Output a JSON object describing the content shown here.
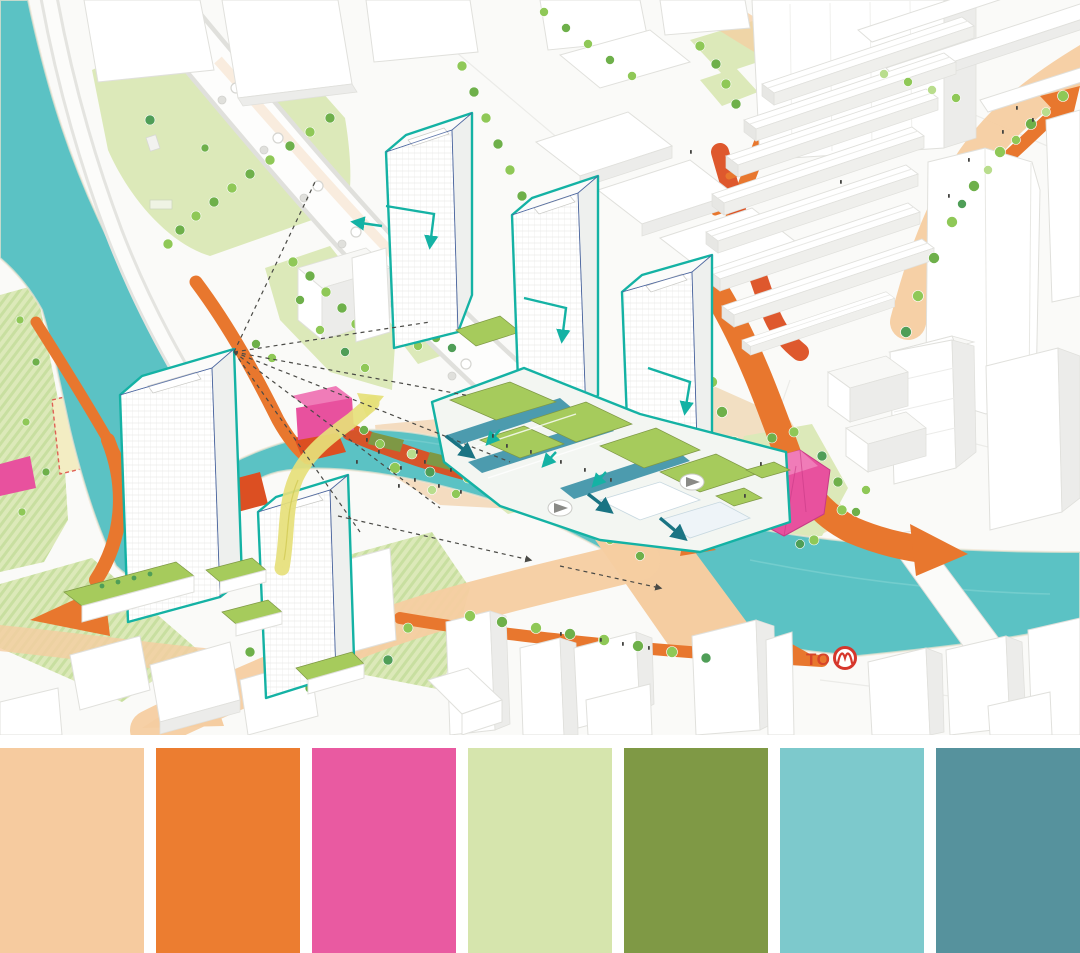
{
  "illustration": {
    "to_label": "TO",
    "icons": {
      "metro": "metro-roundel-icon",
      "viewpoint": "viewpoint-marker-icon",
      "flow": "orange-flow-arrow",
      "bridge": "yellow-bridge-arrow"
    },
    "theme": {
      "bg": "#fafaf8",
      "water": "#5bc2c4",
      "shore": "#efe4d2",
      "teal": "#14b2a4",
      "navy": "#46629c",
      "orange": "#e8772e",
      "orangeDeep": "#dc4f22",
      "peach": "#f5cda1",
      "yellow": "#e6e07a",
      "magenta": "#e8519e",
      "magentaLight": "#f07cb8",
      "magentaDeep": "#c73a86",
      "greenRoof": "#a6cb5c",
      "greenDark": "#7e9845",
      "lawn": "#dce9b9",
      "lawnStripe": "#c8dfa0",
      "tree1": "#8fc857",
      "tree2": "#6eb04a",
      "tree3": "#b9dd8d",
      "tree4": "#4f9e57",
      "deck": "#3e93a8",
      "bldLine": "#e0e0dc",
      "metroRed": "#d6372c"
    }
  },
  "palette": {
    "swatches": [
      {
        "name": "peach",
        "hex": "#f6cb9f"
      },
      {
        "name": "orange",
        "hex": "#ec7d30"
      },
      {
        "name": "magenta-pink",
        "hex": "#e95aa1"
      },
      {
        "name": "light-green",
        "hex": "#d6e5ad"
      },
      {
        "name": "olive-green",
        "hex": "#7f9945"
      },
      {
        "name": "light-teal",
        "hex": "#7dc9cc"
      },
      {
        "name": "dark-teal",
        "hex": "#56929d"
      }
    ]
  }
}
